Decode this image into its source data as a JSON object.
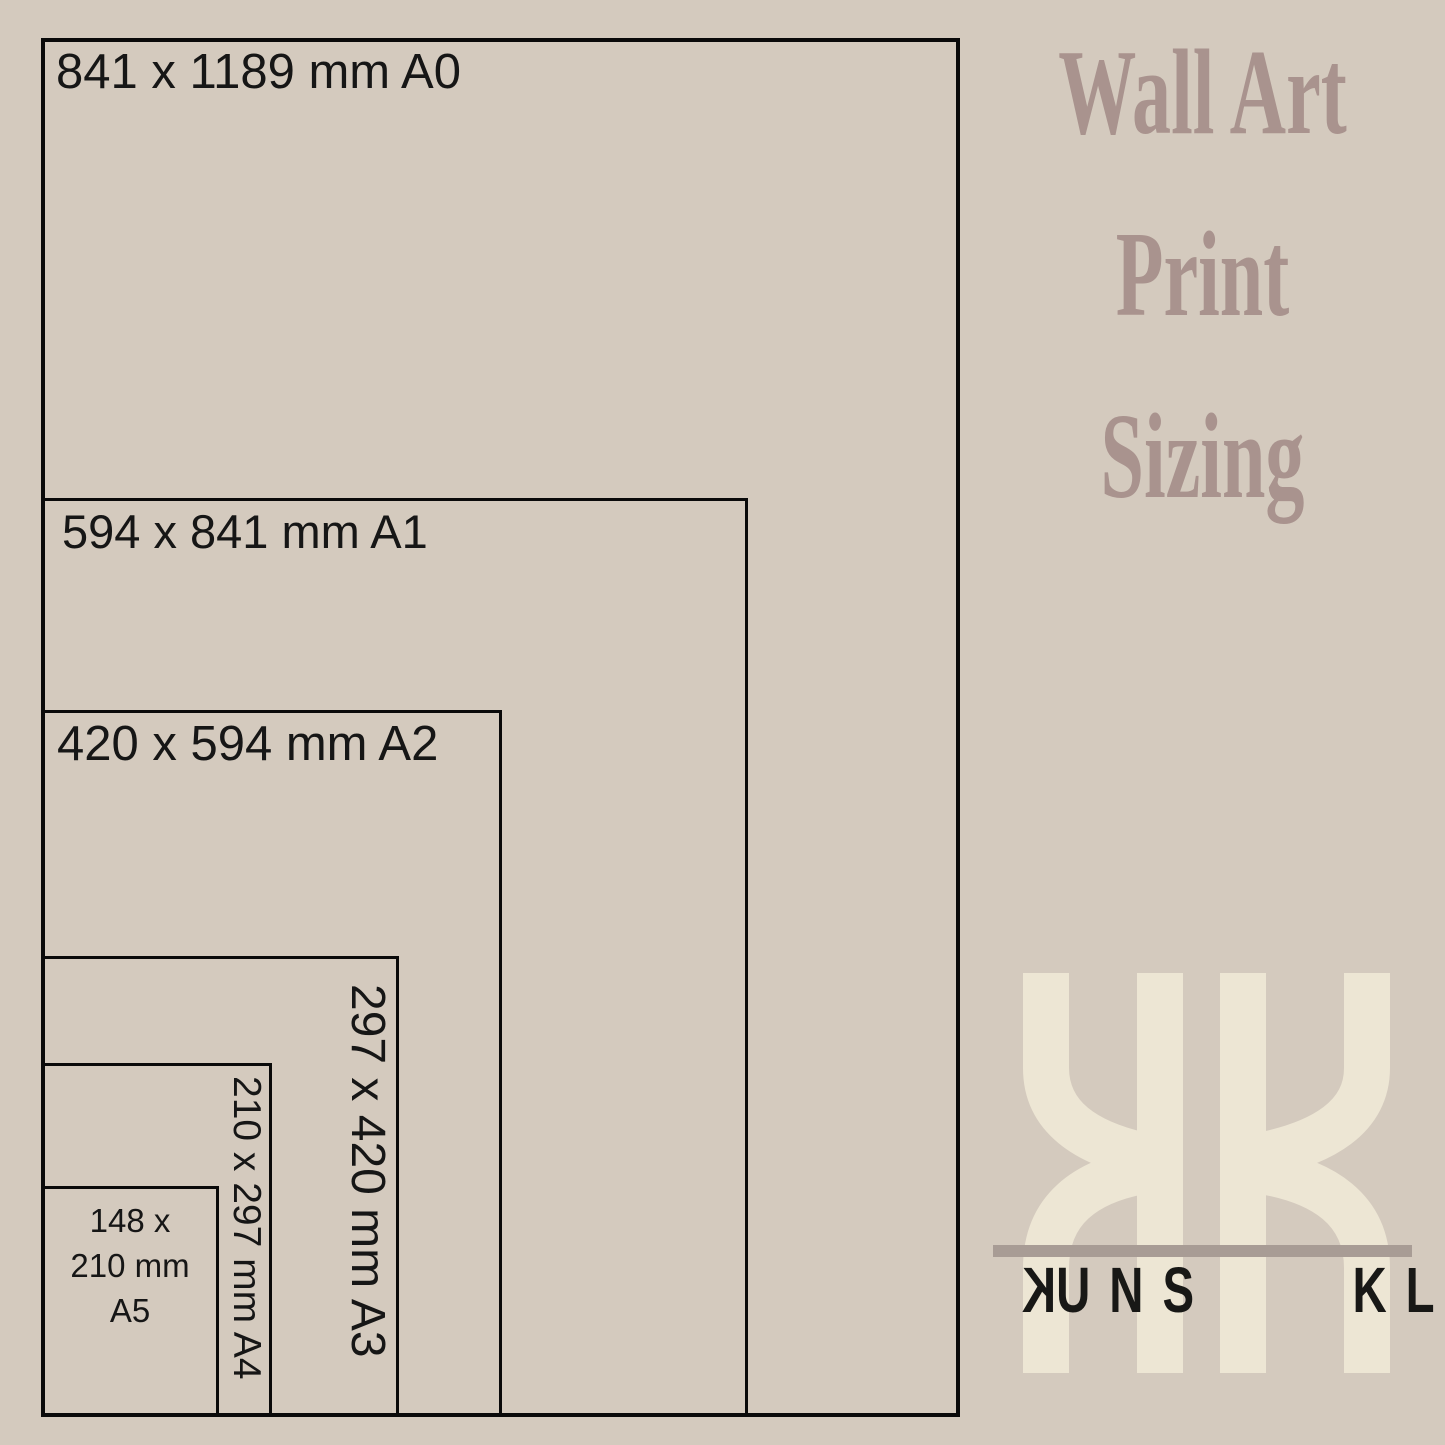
{
  "diagram": {
    "sizes": [
      {
        "id": "A0",
        "dimensions_mm": "841 x 1189",
        "label": "841 x 1189 mm A0",
        "label_orientation": "horizontal"
      },
      {
        "id": "A1",
        "dimensions_mm": "594 x 841",
        "label": "594 x 841 mm A1",
        "label_orientation": "horizontal"
      },
      {
        "id": "A2",
        "dimensions_mm": "420 x 594",
        "label": "420 x 594 mm A2",
        "label_orientation": "horizontal"
      },
      {
        "id": "A3",
        "dimensions_mm": "297 x 420",
        "label": "297 x 420 mm A3",
        "label_orientation": "rotated-90"
      },
      {
        "id": "A4",
        "dimensions_mm": "210 x 297",
        "label": "210 x 297 mm A4",
        "label_orientation": "rotated-90"
      },
      {
        "id": "A5",
        "dimensions_mm": "148 x 210",
        "label": "148 x 210 mm A5",
        "label_orientation": "stacked",
        "label_lines": [
          "148 x",
          "210 mm",
          "A5"
        ]
      }
    ]
  },
  "side_panel": {
    "title_lines": [
      "Wall Art",
      "Print",
      "Sizing"
    ],
    "logo": {
      "monogram": "KK",
      "wordmark": {
        "kuns_first": "K",
        "kuns_rest": "UNS",
        "klik": "KLIK"
      }
    }
  },
  "colors": {
    "background": "#d4cabe",
    "rect_line": "#0a0a0a",
    "label_text": "#161616",
    "title_text": "#a9938e",
    "logo_cream": "#ede6d4",
    "divider_bar": "#a89c95",
    "wordmark_text": "#181816"
  }
}
